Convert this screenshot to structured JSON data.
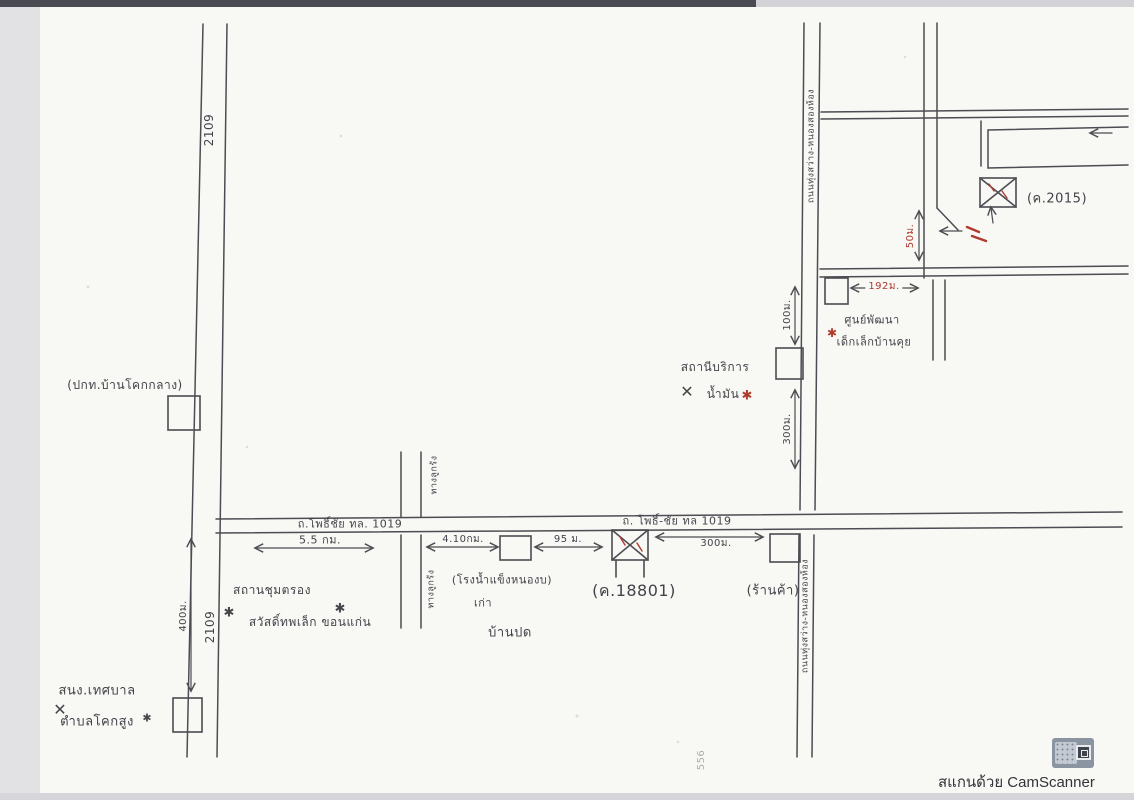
{
  "colors": {
    "ink": "#4c4c52",
    "red_pen": "#b03a2c",
    "paper": "#f8f8f5"
  },
  "glyphs": {
    "star": "✱",
    "cross": "✕"
  },
  "watermark": {
    "text": "สแกนด้วย CamScanner"
  },
  "map_labels": {
    "route_2109_top": "2109",
    "route_2109_bottom": "2109",
    "police": "(ปกท.บ้านโคกกลาง)",
    "municipal_1": "สนง.เทศบาล",
    "municipal_2": "ตำบลโคกสูง",
    "checkpoint_1": "สถานชุมตรอง",
    "checkpoint_2": "สวัสดิ์ทพเล็ก ขอนแก่น",
    "road_phochai_west": "ถ.โพธิ์ชัย ทล. 1019",
    "road_phochai_east": "ถ. โพธิ์-ชัย ทล 1019",
    "dist_5_5km": "5.5 กม.",
    "dist_4_10km": "4.10กม.",
    "dist_95m": "95 ม.",
    "dist_300m": "300ม.",
    "dist_400m": "400ม.",
    "dist_100m": "100ม.",
    "dist_300m_v": "300ม.",
    "dist_192m": "192ม.",
    "dist_50m": "50ม.",
    "subject": "(ค.18801)",
    "landmark": "(ค.2015)",
    "shop": "(ร้านค้า)",
    "icehouse_1": "(โรงน้ำแข็งหนองบ)",
    "icehouse_2": "เก่า",
    "village": "บ้านปด",
    "gas_1": "สถานีบริการ",
    "gas_2": "น้ำมัน",
    "childcenter_1": "ศูนย์พัฒนา",
    "childcenter_2": "เด็กเล็กบ้านคุย",
    "road_a_top": "ถนนทุ่งสว่าง-หนองสองห้อง",
    "road_a_bottom": "ถนนทุ่งสว่าง-หนองสองห้อง",
    "minor_road_top": "ทางลูกรัง",
    "minor_road_bottom": "ทางลูกรัง",
    "faint_556": "556"
  }
}
